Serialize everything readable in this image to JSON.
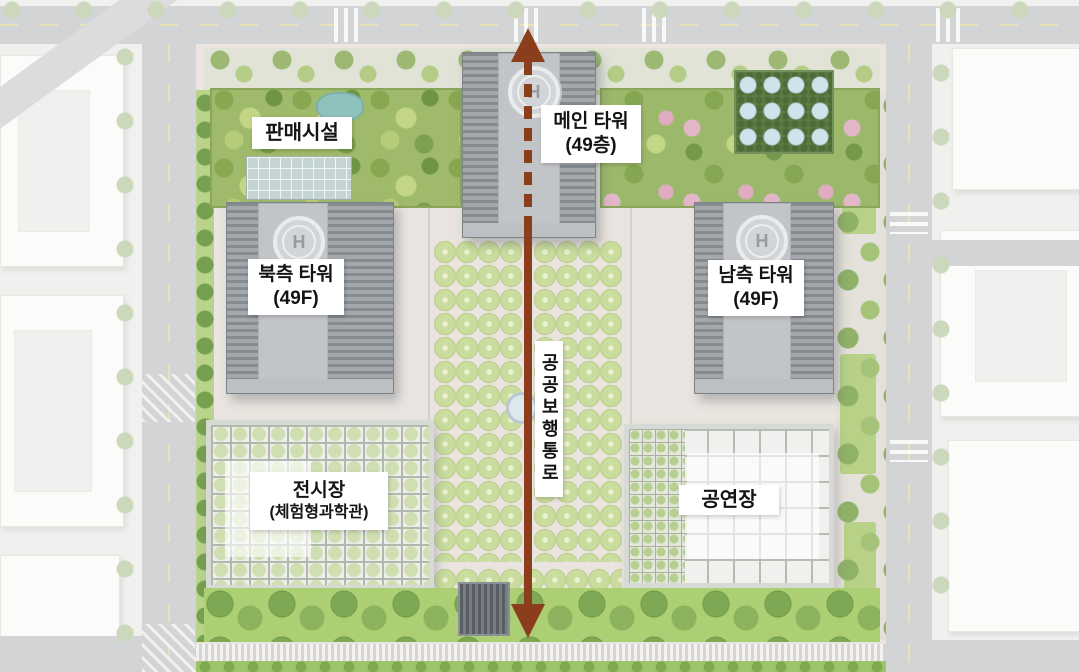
{
  "labels": {
    "retail": "판매시설",
    "main_tower_line1": "메인 타워",
    "main_tower_line2": "(49층)",
    "north_tower_line1": "북측 타워",
    "north_tower_line2": "(49F)",
    "south_tower_line1": "남측 타워",
    "south_tower_line2": "(49F)",
    "exhibition_line1": "전시장",
    "exhibition_line2": "(체험형과학관)",
    "performance": "공연장",
    "pedestrian_axis": "공공보행통로",
    "helipad_letter": "H"
  },
  "colors": {
    "axis_arrow": "#8a3e1c",
    "label_background": "#ffffff",
    "label_text": "#141414",
    "tower_gray": "#9aa0a4",
    "plaza_tree_green": "#c6d89a",
    "garden_green": "#9cba69",
    "lawn_green": "#abcd76",
    "road_gray": "#d3d4d6",
    "pergola_skylight_blue": "#cfe3ea",
    "pond_teal": "#8fc2bd"
  }
}
